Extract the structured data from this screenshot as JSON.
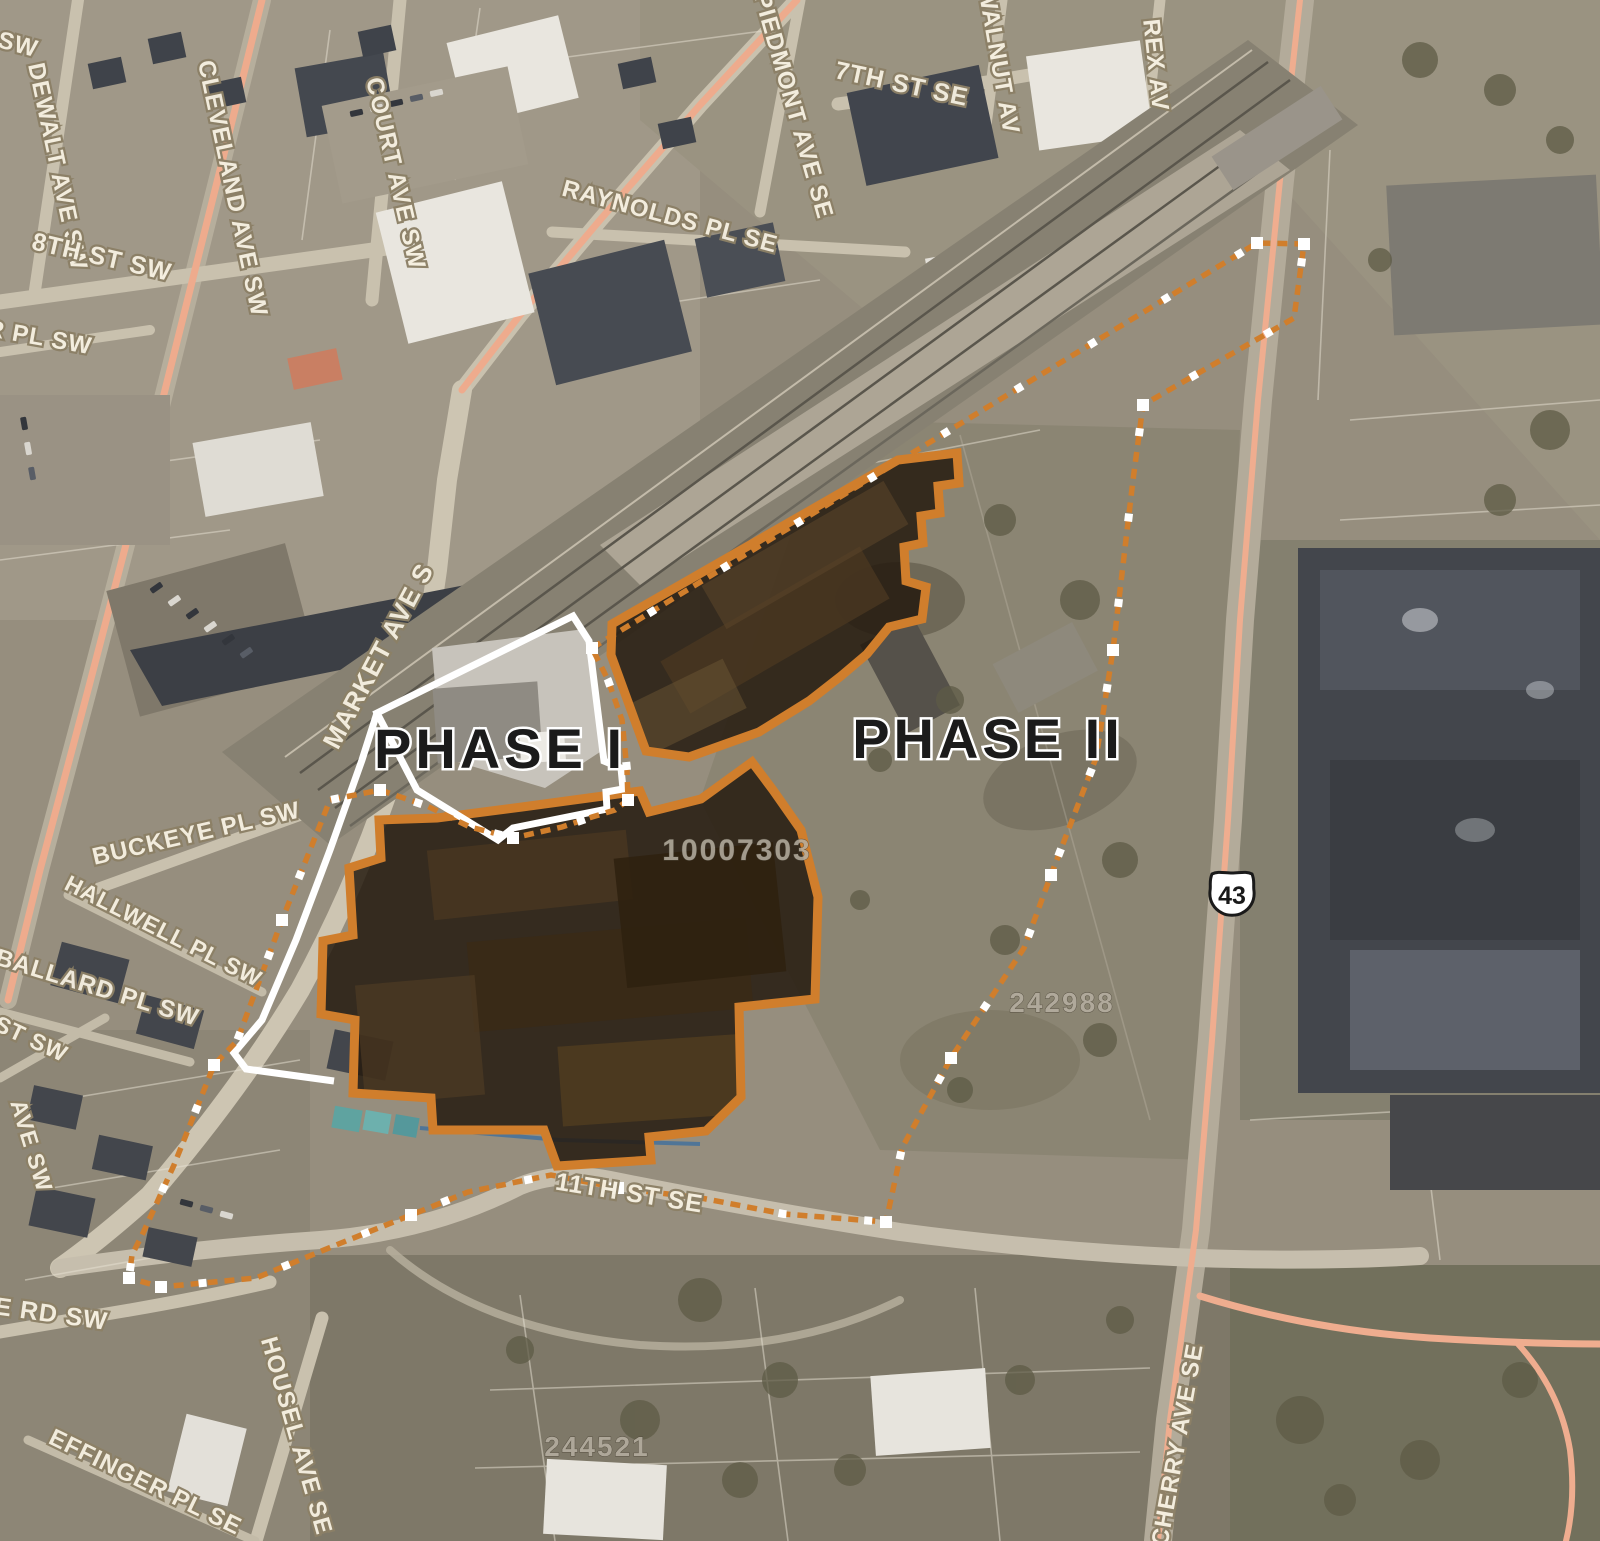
{
  "map": {
    "title": "Aerial site map with phased redevelopment boundaries",
    "phase_labels": {
      "phase1": "PHASE I",
      "phase2": "PHASE II"
    },
    "route_shield": {
      "number": "43"
    },
    "parcel_numbers": [
      {
        "text": "10007303",
        "x": 737,
        "y": 860,
        "size": 30
      },
      {
        "text": "242988",
        "x": 1062,
        "y": 1012,
        "size": 28
      },
      {
        "text": "244521",
        "x": 597,
        "y": 1456,
        "size": 28
      }
    ],
    "street_labels": [
      {
        "text": "SW",
        "x": 16,
        "y": 52,
        "rot": 15,
        "size": 24
      },
      {
        "text": "DEWALT AVE SW",
        "x": 50,
        "y": 168,
        "rot": 78,
        "size": 24
      },
      {
        "text": "8TH ST SW",
        "x": 100,
        "y": 265,
        "rot": 13,
        "size": 25
      },
      {
        "text": "CLEVELAND AVE SW",
        "x": 225,
        "y": 190,
        "rot": 78,
        "size": 24
      },
      {
        "text": "COURT AVE SW",
        "x": 388,
        "y": 175,
        "rot": 77,
        "size": 24
      },
      {
        "text": "R PL SW",
        "x": 38,
        "y": 345,
        "rot": 10,
        "size": 24
      },
      {
        "text": "RAYNOLDS PL SE",
        "x": 668,
        "y": 224,
        "rot": 15,
        "size": 24
      },
      {
        "text": "PIEDMONT AVE SE",
        "x": 786,
        "y": 108,
        "rot": 74,
        "size": 24
      },
      {
        "text": "7TH ST SE",
        "x": 900,
        "y": 92,
        "rot": 12,
        "size": 25
      },
      {
        "text": "WALNUT AV",
        "x": 991,
        "y": 62,
        "rot": 80,
        "size": 24
      },
      {
        "text": "REX AV",
        "x": 1148,
        "y": 66,
        "rot": 84,
        "size": 24
      },
      {
        "text": "MARKET AVE S",
        "x": 386,
        "y": 660,
        "rot": -62,
        "size": 26
      },
      {
        "text": "BUCKEYE PL SW",
        "x": 198,
        "y": 841,
        "rot": -13,
        "size": 24
      },
      {
        "text": "HALLWELL PL SW",
        "x": 160,
        "y": 938,
        "rot": 27,
        "size": 23
      },
      {
        "text": "BALLARD PL SW",
        "x": 95,
        "y": 995,
        "rot": 17,
        "size": 24
      },
      {
        "text": "ST SW",
        "x": 28,
        "y": 1046,
        "rot": 25,
        "size": 23
      },
      {
        "text": "AVE SW",
        "x": 24,
        "y": 1148,
        "rot": 73,
        "size": 23
      },
      {
        "text": "E RD SW",
        "x": 50,
        "y": 1322,
        "rot": 8,
        "size": 25
      },
      {
        "text": "11TH ST SE",
        "x": 628,
        "y": 1201,
        "rot": 9,
        "size": 25
      },
      {
        "text": "HOUSEL AVE SE",
        "x": 289,
        "y": 1438,
        "rot": 74,
        "size": 24
      },
      {
        "text": "EFFINGER PL SE",
        "x": 142,
        "y": 1489,
        "rot": 26,
        "size": 24
      },
      {
        "text": "CHERRY AVE SE",
        "x": 1185,
        "y": 1446,
        "rot": -80,
        "size": 24
      }
    ],
    "colors": {
      "site_orange": "#d07e2c",
      "outline_white": "#ffffff",
      "street_label_fill": "#f6f0e1",
      "street_label_outline": "#8c8066",
      "phase_label_fill": "#1b1b1b",
      "phase_label_halo": "#ffffff",
      "parcel_number_fill": "#b7b0a2",
      "overlay_dark": "#241a0e",
      "shield_fill": "#ffffff",
      "shield_text": "#1a1a1a"
    }
  }
}
